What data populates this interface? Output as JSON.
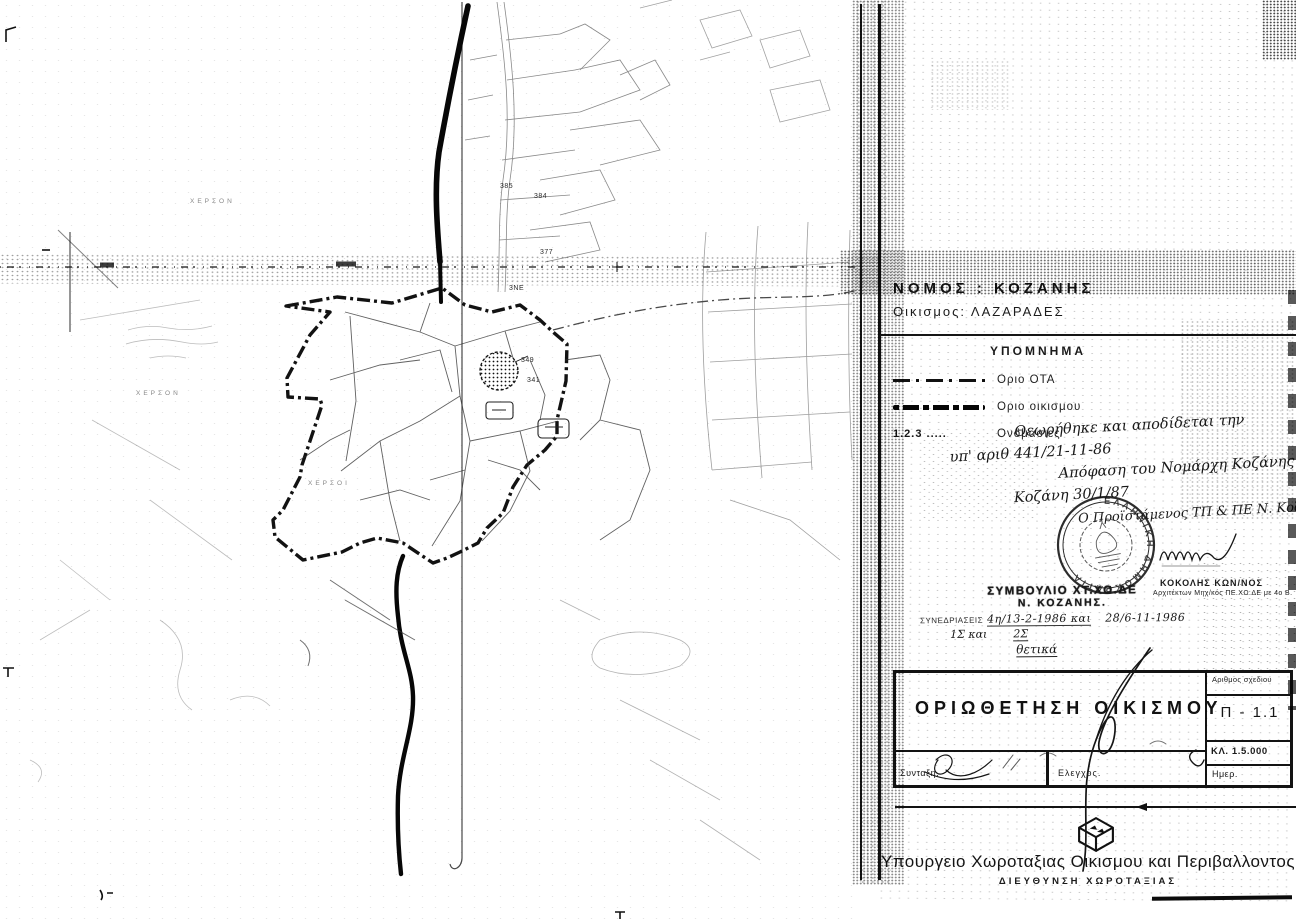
{
  "document": {
    "prefecture_label": "ΝΟΜΟΣ : ΚΟΖΑΝΗΣ",
    "settlement_label": "Οικισμος:  ΛΑΖΑΡΑΔΕΣ"
  },
  "legend": {
    "title": "ΥΠΟΜΝΗΜΑ",
    "items": [
      {
        "sym": "sym-thin",
        "label": "Οριο ΟΤΑ"
      },
      {
        "sym": "sym-thick",
        "label": "Οριο οικισμου"
      },
      {
        "sym": "sym-text",
        "symbol_text": "1.2.3 .....",
        "label": "Ονομασιες"
      }
    ]
  },
  "approval_note": {
    "lines": [
      "Θεωρήθηκε και αποδίδεται την",
      "υπ' αριθ 441/21-11-86",
      "Απόφαση του Νομάρχη Κοζάνης",
      "Κοζάνη 30/1/87"
    ]
  },
  "round_stamp": {
    "ring_text": "ΕΛΛΗΝΙΚΗ ΔΗΜΟΚΡΑΤΙΑ",
    "handwritten_title": "Ο Προϊστάμενος ΤΠ & ΠΕ Ν. Κοζάνης",
    "signer_name": "ΚΟΚΟΛΗΣ ΚΩΝ/ΝΟΣ",
    "signer_role": "Αρχιτέκτων Μηχ/κός ΠΕ.ΧΩ.ΔΕ με 4ο Β."
  },
  "council_stamp": {
    "line1": "ΣΥΜΒΟΥΛΙΟ ΧΤ.ΧΟ.ΔΕ",
    "line2": "Ν. ΚΟΖΑΝΗΣ.",
    "sessions_label": "ΣΥΝΕΔΡΙΑΣΕΙΣ",
    "sessions_value": "4η/13-2-1986 και",
    "sessions_value2": "28/6-11-1986",
    "acts_prefix": "1Σ και",
    "acts_suffix": "2Σ",
    "verdict": "θετικά"
  },
  "title_block": {
    "title": "ΟΡΙΩΘΕΤΗΣΗ  ΟΙΚΙΣΜΟΥ",
    "drawing_no_label": "Αριθμος σχεδιου",
    "drawing_no": "Π - 1.1",
    "scale": "ΚΛ.  1.5.000",
    "prepared_label": "Συνταξη.",
    "checked_label": "Ελεγχος.",
    "date_label": "Ημερ."
  },
  "footer": {
    "ministry": "Υπουργειο  Χωροταξιας  Οικισμου  και  Περιβαλλοντος",
    "directorate": "ΔΙΕΥΘΥΝΣΗ  ΧΩΡΟΤΑΞΙΑΣ"
  },
  "map": {
    "scale_note": "1:5.000",
    "labels": [
      {
        "text": "385",
        "x": 500,
        "y": 183
      },
      {
        "text": "384",
        "x": 534,
        "y": 193
      },
      {
        "text": "377",
        "x": 540,
        "y": 249
      },
      {
        "text": "3ΝΕ",
        "x": 509,
        "y": 285
      },
      {
        "text": "349",
        "x": 521,
        "y": 357
      },
      {
        "text": "341",
        "x": 527,
        "y": 377
      },
      {
        "text": "ΧΕΡΣΟΝ",
        "x": 190,
        "y": 198,
        "cls": "faint"
      },
      {
        "text": "ΧΕΡΣΟΝ",
        "x": 136,
        "y": 390,
        "cls": "faint"
      },
      {
        "text": "ΧΕΡΣΟΙ",
        "x": 308,
        "y": 480,
        "cls": "faint"
      }
    ],
    "colors": {
      "ink": "#1b1b1b",
      "faint": "#666666"
    }
  }
}
